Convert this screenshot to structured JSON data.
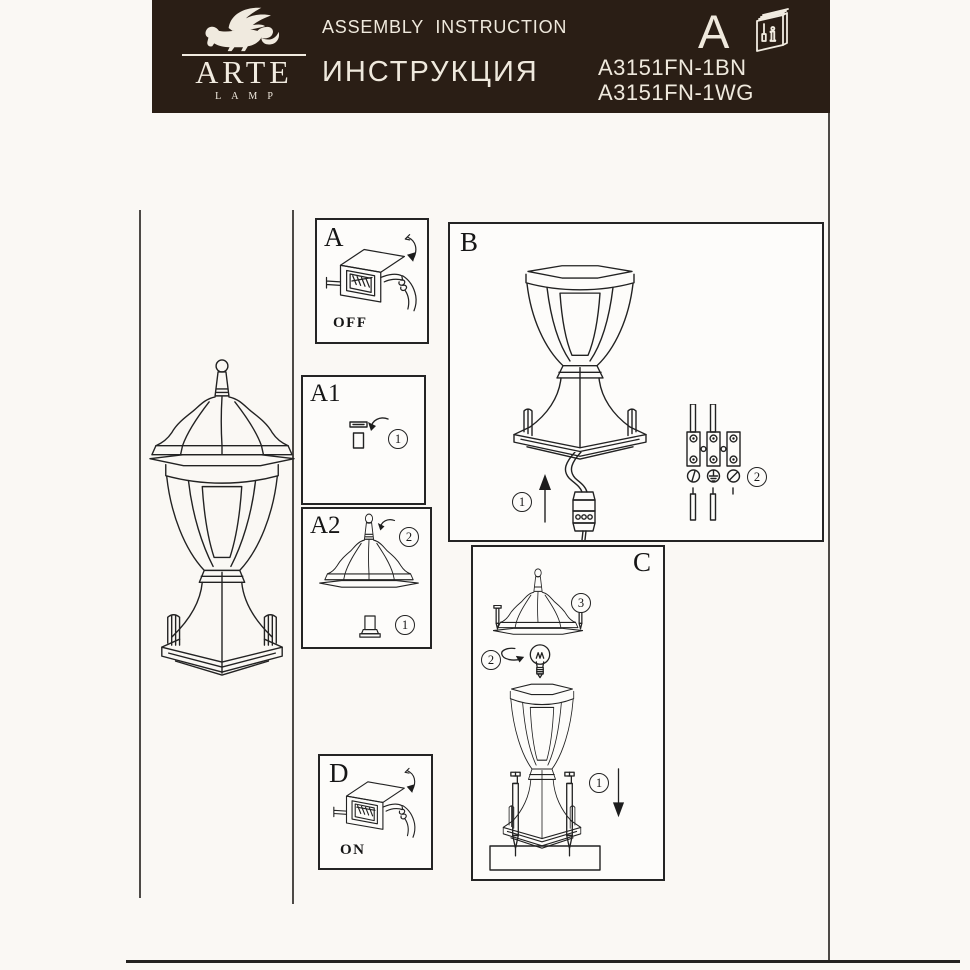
{
  "header": {
    "logo": {
      "brand": "ARTE",
      "sub": "LAMP",
      "icon": "winged-lion"
    },
    "title_en": "ASSEMBLY  INSTRUCTION",
    "title_ru": "ИНСТРУКЦИЯ",
    "page_letter": "A",
    "book_i": "i",
    "models": [
      "A3151FN-1BN",
      "A3151FN-1WG"
    ],
    "colors": {
      "bg": "#2A1E15",
      "text": "#EFE9DD"
    }
  },
  "panels": {
    "a": {
      "label": "A",
      "caption": "OFF"
    },
    "a1": {
      "label": "A1",
      "step_screw": "1"
    },
    "a2": {
      "label": "A2",
      "step_cover": "2",
      "step_screw": "1"
    },
    "b": {
      "label": "B",
      "step_cable": "1",
      "step_wiring": "2"
    },
    "c": {
      "label": "C",
      "step_cover": "3",
      "step_bulb": "2",
      "step_mount": "1"
    },
    "d": {
      "label": "D",
      "caption": "ON"
    }
  },
  "colors": {
    "ink": "#222222",
    "page": "#FAF8F4"
  }
}
